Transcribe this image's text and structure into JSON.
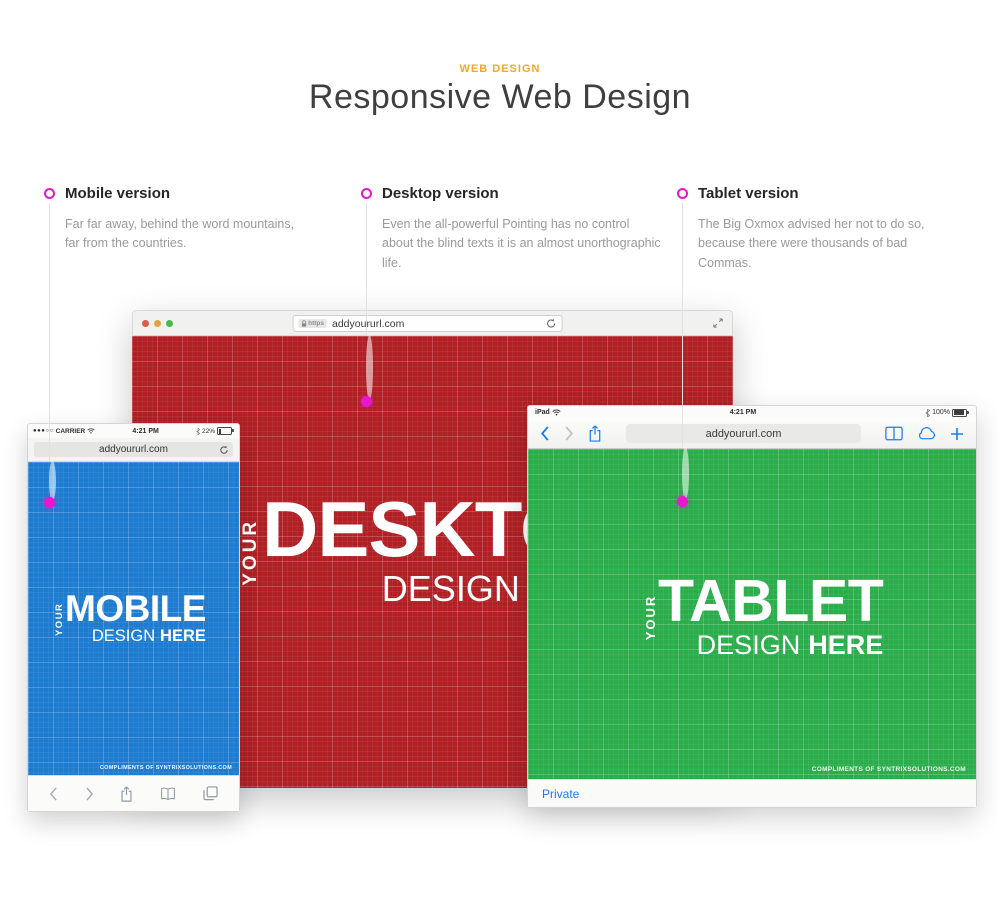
{
  "header": {
    "eyebrow": "WEB DESIGN",
    "title": "Responsive Web Design"
  },
  "annotations": [
    {
      "label": "Mobile version",
      "description": "Far far away, behind the word mountains, far from the countries."
    },
    {
      "label": "Desktop version",
      "description": "Even the all-powerful Pointing has no control about the blind texts it is an almost unorthographic life."
    },
    {
      "label": "Tablet version",
      "description": "The Big Oxmox advised her not to do so, because there were thousands of bad Commas."
    }
  ],
  "desktop_mockup": {
    "https_badge": "https",
    "url": "addyoururl.com",
    "placeholder": {
      "your": "YOUR",
      "device": "DESKTOP",
      "design": "DESIGN",
      "here": "HERE"
    }
  },
  "mobile_mockup": {
    "status_bar": {
      "signal": "●●●○○",
      "carrier": "CARRIER",
      "time": "4:21 PM",
      "battery_percent": "22%"
    },
    "url": "addyoururl.com",
    "placeholder": {
      "your": "YOUR",
      "device": "MOBILE",
      "design": "DESIGN",
      "here": "HERE"
    },
    "credit": "COMPLIMENTS OF SYNTRIXSOLUTIONS.COM"
  },
  "tablet_mockup": {
    "status_bar": {
      "device": "iPad",
      "time": "4:21 PM",
      "battery_percent": "100%"
    },
    "url": "addyoururl.com",
    "placeholder": {
      "your": "YOUR",
      "device": "TABLET",
      "design": "DESIGN",
      "here": "HERE"
    },
    "credit": "COMPLIMENTS OF SYNTRIXSOLUTIONS.COM",
    "private_label": "Private"
  },
  "colors": {
    "accent_orange": "#F5A623",
    "marker_magenta": "#E816CE",
    "mobile_blue": "#1E7CD0",
    "desktop_red": "#B02024",
    "tablet_green": "#2CAD4B",
    "ios_blue": "#157EFB"
  }
}
